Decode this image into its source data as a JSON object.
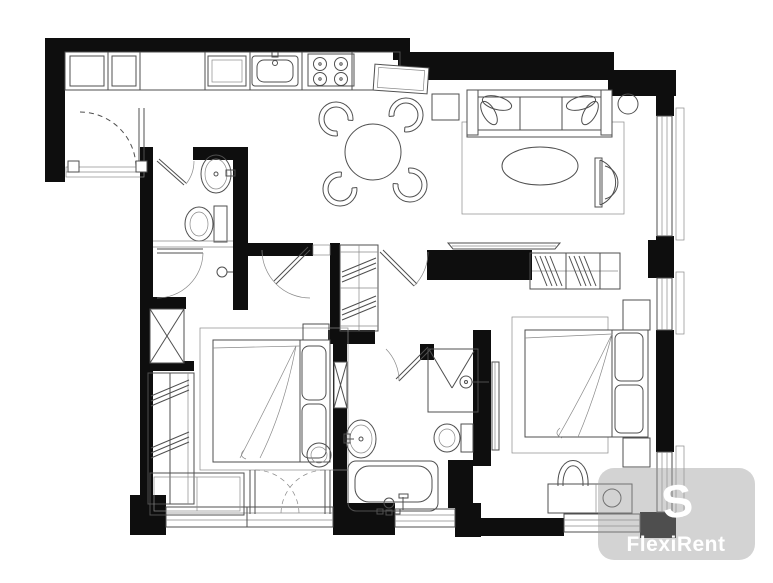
{
  "watermark": {
    "brand": "FlexiRent",
    "logo_glyph": "S",
    "logo_icon": "swirl-s-logo",
    "badge_color": "#9e9e9e",
    "badge_opacity": "0.45",
    "text_color": "#ffffff"
  },
  "palette": {
    "wall": "#0e0e0e",
    "line": "#4f4f4f",
    "thin_line": "#8a8a8a",
    "background": "#ffffff"
  },
  "floor_plan": {
    "title": "Two-bedroom apartment floor plan",
    "rooms": [
      {
        "id": "entry",
        "fixtures": [
          "entry-door-dashed-swing",
          "threshold"
        ]
      },
      {
        "id": "kitchen",
        "fixtures": [
          "counter-run",
          "cabinets",
          "kitchen-sink",
          "stove-4-burner",
          "appliance-box"
        ]
      },
      {
        "id": "dining-area",
        "fixtures": [
          "round-table",
          "chair-x4",
          "square-side-table"
        ]
      },
      {
        "id": "living-room",
        "fixtures": [
          "sofa-3-seat",
          "rug",
          "oval-coffee-table",
          "armchair",
          "round-side-table",
          "tv-panel"
        ]
      },
      {
        "id": "bathroom-1",
        "fixtures": [
          "wash-basin",
          "toilet",
          "door-swing"
        ]
      },
      {
        "id": "hallway",
        "fixtures": [
          "door-swing-x3",
          "door-handle",
          "thresholds"
        ]
      },
      {
        "id": "bedroom-1",
        "fixtures": [
          "double-bed",
          "pillows",
          "blanket-fold",
          "rug",
          "bedside-shelf",
          "round-stool",
          "bench",
          "wardrobe-hatched",
          "linen-closet-x",
          "french-doors-dashed"
        ]
      },
      {
        "id": "bathroom-2",
        "fixtures": [
          "shower-enclosure",
          "shower-head",
          "toilet",
          "pedestal-basin",
          "bathtub",
          "door-swing"
        ]
      },
      {
        "id": "bedroom-2",
        "fixtures": [
          "double-bed",
          "pillows",
          "blanket-fold",
          "rug",
          "bedside-table-x2",
          "wardrobe-hatched",
          "vanity-desk",
          "basin-circle",
          "chair",
          "sliding-panel"
        ]
      },
      {
        "id": "windows",
        "fixtures": [
          "window-right-x3",
          "window-bottom-x3",
          "outer-sills"
        ]
      }
    ]
  }
}
